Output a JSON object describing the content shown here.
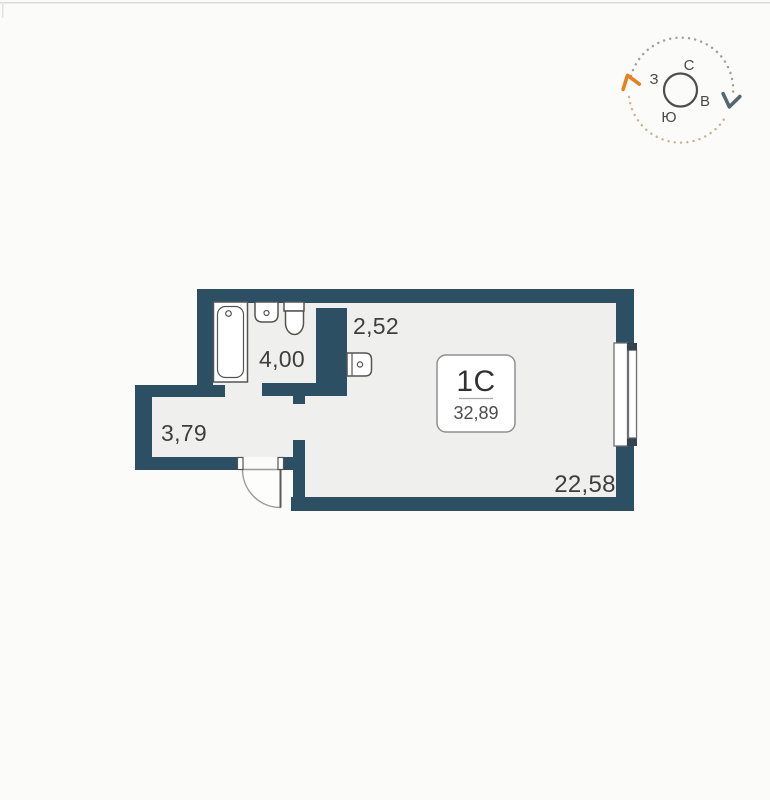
{
  "page": {
    "background": "#fbfbf9",
    "top_border_color": "#d8d8d7"
  },
  "compass": {
    "north": "С",
    "south": "Ю",
    "west": "З",
    "east": "В",
    "colors": {
      "letters": "#4a4a4a",
      "ring": "#4d4d4d",
      "rotate_arrow_orange": "#ea801c",
      "chevron_gray": "#556871",
      "dots_gray": "#9f9f9f",
      "dots_tan": "#c6b68c"
    }
  },
  "plan": {
    "unit_card": {
      "code": "1С",
      "area": "32,89"
    },
    "rooms": [
      {
        "id": "kitchen-niche",
        "area": "2,52"
      },
      {
        "id": "bathroom",
        "area": "4,00"
      },
      {
        "id": "hallway",
        "area": "3,79"
      },
      {
        "id": "living-room",
        "area": "22,58"
      }
    ],
    "colors": {
      "wall": "#2c4f63",
      "floor": "#eff0ee",
      "fixture_stroke": "#545454",
      "label_text": "#3e3e3e"
    }
  }
}
